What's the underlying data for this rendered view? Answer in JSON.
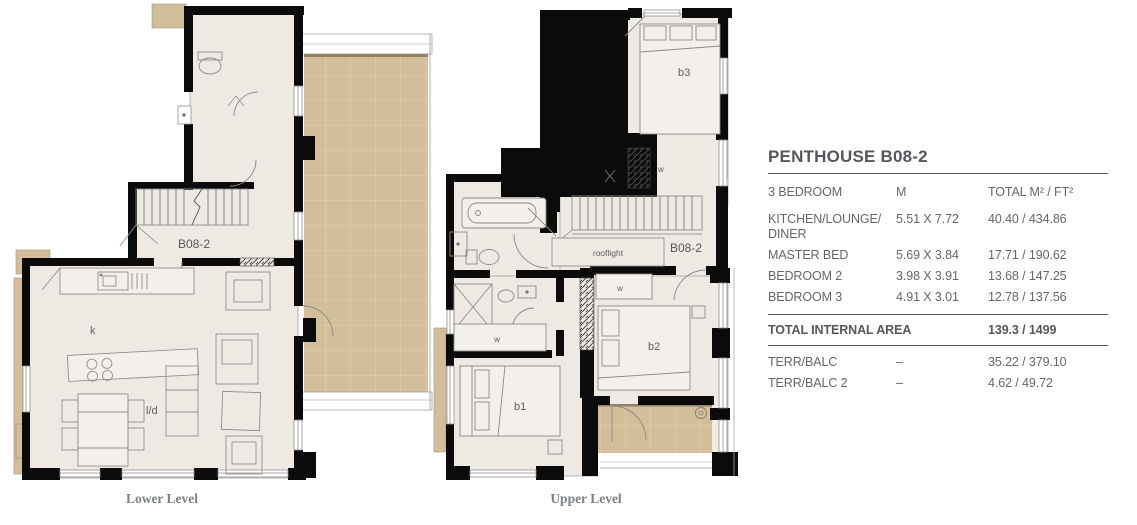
{
  "panel": {
    "title": "PENTHOUSE B08-2",
    "columns": {
      "c1": "3 BEDROOM",
      "c2": "M",
      "c3": "TOTAL M² / FT²"
    },
    "rooms": [
      {
        "name": "KITCHEN/LOUNGE/\nDINER",
        "m": "5.51 X 7.72",
        "total": "40.40 / 434.86"
      },
      {
        "name": "MASTER BED",
        "m": "5.69 X 3.84",
        "total": "17.71 / 190.62"
      },
      {
        "name": "BEDROOM 2",
        "m": "3.98 X 3.91",
        "total": "13.68 / 147.25"
      },
      {
        "name": "BEDROOM 3",
        "m": "4.91 X 3.01",
        "total": "12.78 / 137.56"
      }
    ],
    "total": {
      "label": "TOTAL INTERNAL AREA",
      "value": "139.3 / 1499"
    },
    "terraces": [
      {
        "name": "TERR/BALC",
        "m": "–",
        "total": "35.22 / 379.10"
      },
      {
        "name": "TERR/BALC 2",
        "m": "–",
        "total": "4.62 / 49.72"
      }
    ]
  },
  "plans": {
    "lower": {
      "label": "Lower Level",
      "unit": "B08-2",
      "kitchen": "k",
      "lounge_diner": "l/d"
    },
    "upper": {
      "label": "Upper Level",
      "unit": "B08-2",
      "bed1": "b1",
      "bed2": "b2",
      "bed3": "b3",
      "wardrobe": "w",
      "rooflight": "rooflight"
    }
  },
  "colors": {
    "wall": "#0B0B0B",
    "floor": "#EFE9E4",
    "terrace": "#D2BF99",
    "terrace_grid": "#DECDA9",
    "text_gray": "#63666B",
    "text_dark": "#54575B",
    "plan_caption": "#7B8084"
  }
}
